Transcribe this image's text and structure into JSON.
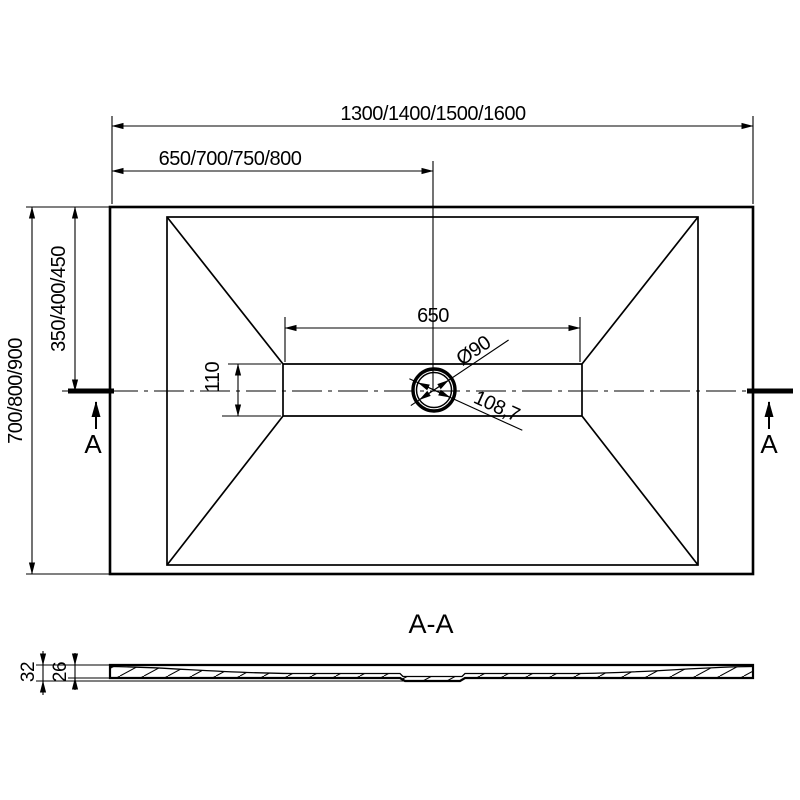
{
  "drawing": {
    "colors": {
      "line": "#000000",
      "background": "#ffffff"
    },
    "top_view": {
      "dim_overall_length": "1300/1400/1500/1600",
      "dim_half_length": "650/700/750/800",
      "dim_overall_width": "700/800/900",
      "dim_half_width": "350/400/450",
      "dim_channel_length": "650",
      "dim_channel_width": "110",
      "drain_diameter": "Ø90",
      "drain_diagonal": "108,7",
      "section_marker_left": "A",
      "section_marker_right": "A"
    },
    "section_view": {
      "title": "A-A",
      "dim_total_thickness": "32",
      "dim_edge_thickness": "26"
    }
  }
}
